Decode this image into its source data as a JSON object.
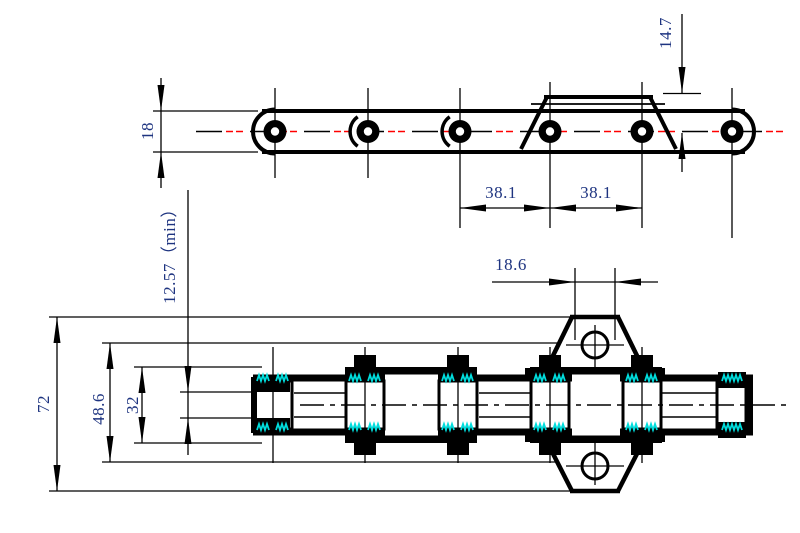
{
  "drawing": {
    "colors": {
      "line": "#000000",
      "dim_text": "#1e3480",
      "centerline_red": "#ff0000",
      "hatch_cyan": "#00dddd"
    },
    "top_view": {
      "dims": {
        "plate_height": "18",
        "attachment_height": "14.7",
        "pitch_a": "38.1",
        "pitch_b": "38.1"
      }
    },
    "bottom_view": {
      "dims": {
        "inner_width_min": "12.57（min）",
        "hole_offset": "18.6",
        "overall_width": "72",
        "pin_width": "48.6",
        "inner_plate_width": "32"
      }
    }
  }
}
